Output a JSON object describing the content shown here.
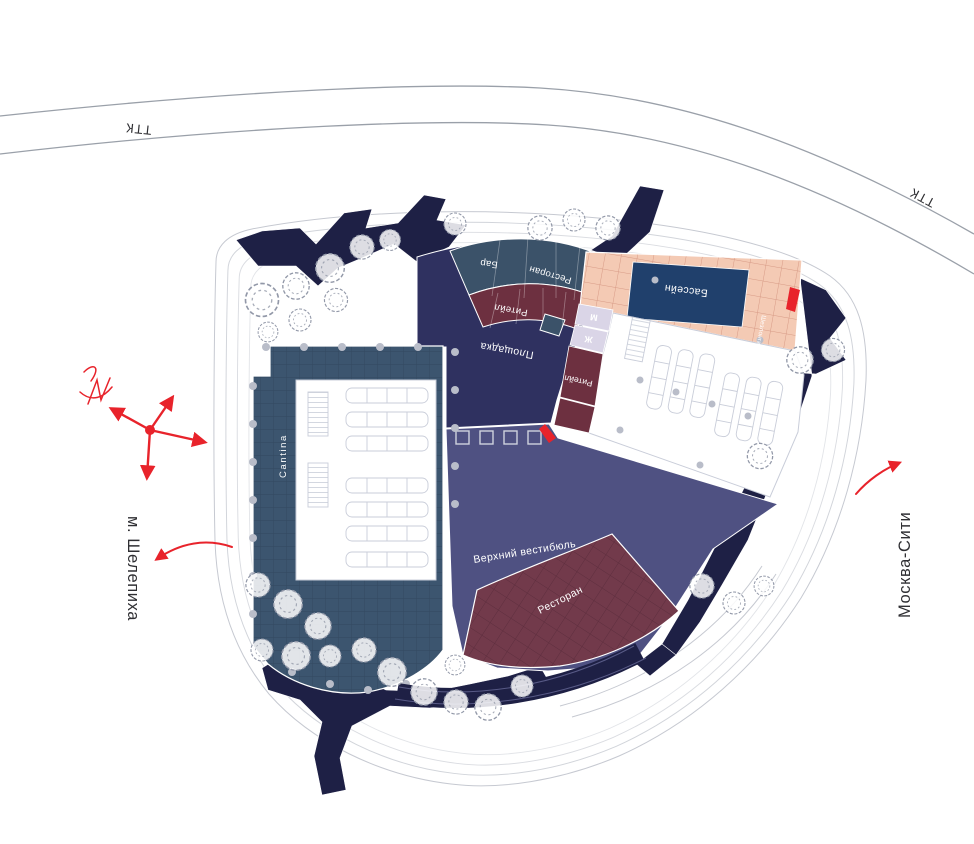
{
  "roads": {
    "ttk_left": "ТТК",
    "ttk_right": "ТТК"
  },
  "directions": {
    "metro": "м. Шелепиха",
    "city": "Москва-Сити"
  },
  "zones": {
    "cantina": "Cantina",
    "playground": "Площадка",
    "upper_vestibule": "Верхний вестибюль",
    "bar": "Бар",
    "restaurant_top": "Ресторан",
    "retail_arc": "Ритейл",
    "retail_side": "Ритейл",
    "restaurant_main": "Ресторан",
    "pool": "Бассейн",
    "loungers": "Шезлонги",
    "wc_men": "М",
    "wc_women": "Ж"
  },
  "colors": {
    "navy_path": "#1e2045",
    "plaza": "#2f3160",
    "vestibule": "#4f5182",
    "cantina": "#3c556f",
    "band_slate": "#3b5269",
    "band_maroon": "#6d3040",
    "restaurant": "#723a4b",
    "deck": "#f4cab4",
    "pool": "#20406c",
    "lavender": "#dad5e7",
    "red": "#e8232b",
    "tree": "#9298a8",
    "contour": "#c6c9d1",
    "road": "#9aa0a9",
    "label_dark": "#2f2f33",
    "white": "#ffffff",
    "furniture": "#c9cdd9",
    "column_dot": "#b9bdc9"
  }
}
